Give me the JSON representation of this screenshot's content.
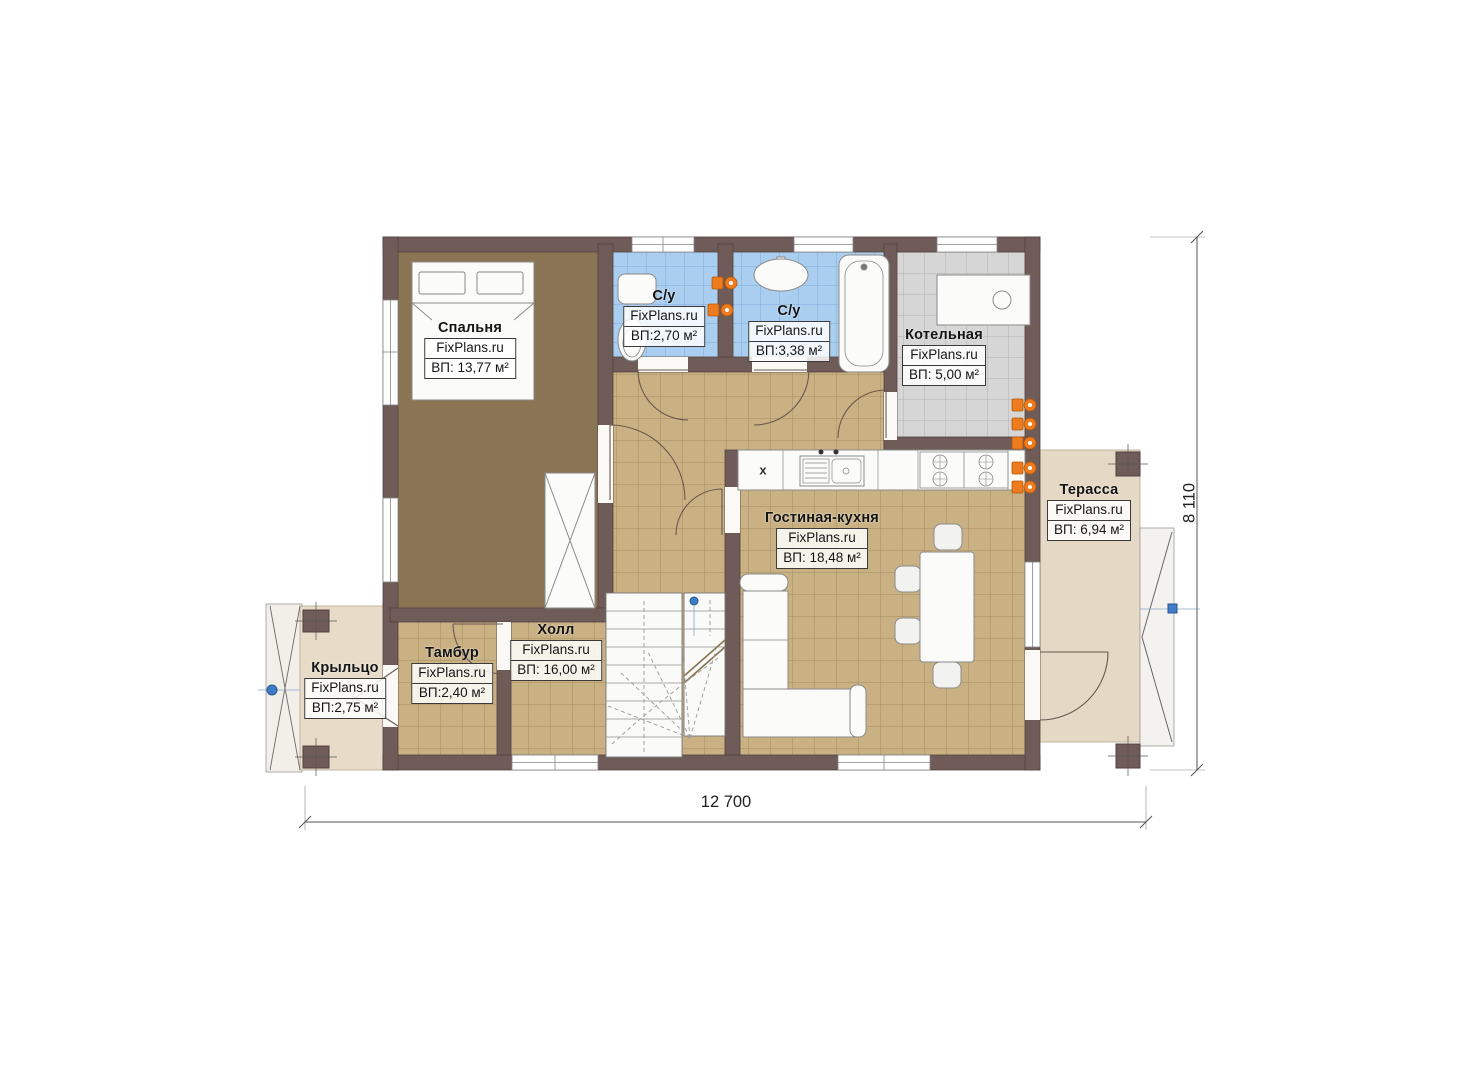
{
  "plan": {
    "brand": "FixPlans.ru",
    "rooms": [
      {
        "id": "bedroom",
        "name": "Спальня",
        "brand": "FixPlans.ru",
        "area": "ВП: 13,77 м²"
      },
      {
        "id": "bathroom-1",
        "name": "С/у",
        "brand": "FixPlans.ru",
        "area": "ВП:2,70 м²"
      },
      {
        "id": "bathroom-2",
        "name": "С/у",
        "brand": "FixPlans.ru",
        "area": "ВП:3,38 м²"
      },
      {
        "id": "boiler-room",
        "name": "Котельная",
        "brand": "FixPlans.ru",
        "area": "ВП: 5,00 м²"
      },
      {
        "id": "terrace",
        "name": "Терасса",
        "brand": "FixPlans.ru",
        "area": "ВП: 6,94 м²"
      },
      {
        "id": "living-kitchen",
        "name": "Гостиная-кухня",
        "brand": "FixPlans.ru",
        "area": "ВП: 18,48 м²"
      },
      {
        "id": "hall",
        "name": "Холл",
        "brand": "FixPlans.ru",
        "area": "ВП: 16,00 м²"
      },
      {
        "id": "vestibule",
        "name": "Тамбур",
        "brand": "FixPlans.ru",
        "area": "ВП:2,40 м²"
      },
      {
        "id": "porch",
        "name": "Крыльцо",
        "brand": "FixPlans.ru",
        "area": "ВП:2,75 м²"
      }
    ],
    "dimensions": {
      "width": "12 700",
      "height": "8 110"
    },
    "kitchen": {
      "fridge_symbol": "x"
    },
    "colors": {
      "wall": "#6f5c59",
      "floor_tile": "#c9b184",
      "bathroom_tile": "#aaceef",
      "boiler_tile": "#d6d6d6",
      "bedroom_wood": "#8b7454",
      "outdoor_floor": "#e5d9c5",
      "radiator": "#ee7b1d",
      "marker": "#3f7dc8"
    }
  }
}
